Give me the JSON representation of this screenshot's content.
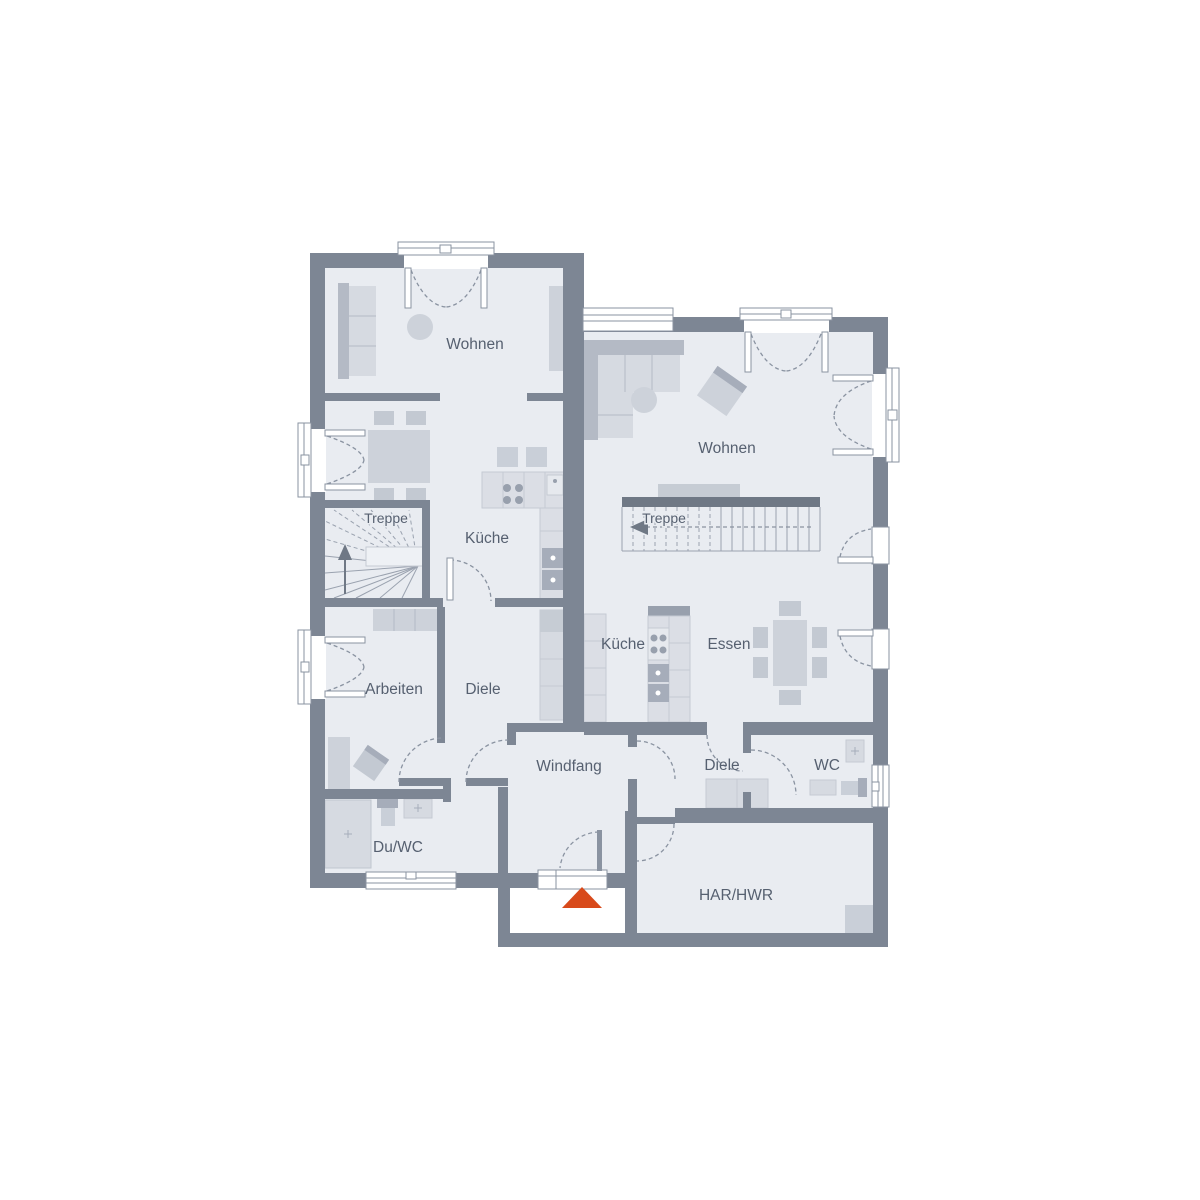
{
  "rooms": {
    "wohnen_left": {
      "label": "Wohnen"
    },
    "treppe_left": {
      "label": "Treppe"
    },
    "kueche_left": {
      "label": "Küche"
    },
    "arbeiten": {
      "label": "Arbeiten"
    },
    "diele_left": {
      "label": "Diele"
    },
    "du_wc": {
      "label": "Du/WC"
    },
    "windfang": {
      "label": "Windfang"
    },
    "wohnen_right": {
      "label": "Wohnen"
    },
    "treppe_right": {
      "label": "Treppe"
    },
    "kueche_right": {
      "label": "Küche"
    },
    "essen": {
      "label": "Essen"
    },
    "diele_right": {
      "label": "Diele"
    },
    "wc": {
      "label": "WC"
    },
    "har_hwr": {
      "label": "HAR/HWR"
    }
  },
  "colors": {
    "wall": "#7d8694",
    "floor": "#e9ecf1",
    "furniture_light": "#d6dae1",
    "furniture_dark": "#b4bac5",
    "stair_dark": "#6f7885",
    "text": "#566070",
    "entrance_arrow": "#d84a1b"
  }
}
